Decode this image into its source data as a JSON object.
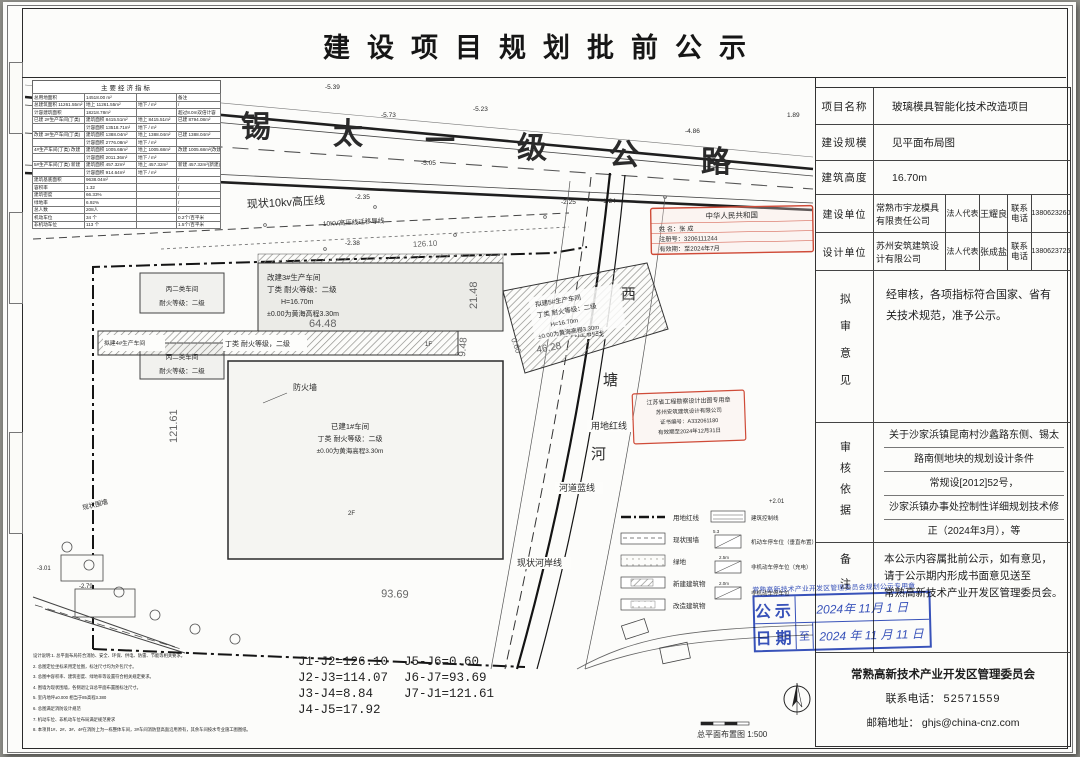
{
  "header": {
    "title": "建设项目规划批前公示"
  },
  "indicators": {
    "title": "主要经济指标",
    "rows": [
      [
        "总用地面积",
        "14518.00 m²",
        "",
        "备注"
      ],
      [
        "总建筑面积 11261.55m²",
        "地上 11261.55m²",
        "地下 / m²",
        "/"
      ],
      [
        "计容建筑面积",
        "18218.78m²",
        "",
        "超过8.0m双倍计容"
      ],
      [
        "已建 2#生产车间(丁类)",
        "建筑面积 8415.51m²",
        "地上 8415.51m²",
        "已建 8794.08m²"
      ],
      [
        "",
        "计容面积 13518.71m²",
        "地下 / m²",
        ""
      ],
      [
        "改建 3#生产车间(丁类)",
        "建筑面积 1388.04m²",
        "地上 1388.04m²",
        "已建 1388.04m²"
      ],
      [
        "",
        "计容面积 2776.08m²",
        "地下 / m²",
        ""
      ],
      [
        "4#生产车间(丁类) 改建",
        "建筑面积 1005.68m²",
        "地上 1005.68m²",
        "改建 1005.68m²(改建)"
      ],
      [
        "",
        "计容面积 2011.36m²",
        "地下 / m²",
        ""
      ],
      [
        "5#生产车间(丁类) 新建",
        "建筑面积 457.32m²",
        "地上 457.32m²",
        "新建 457.32m²(新建)"
      ],
      [
        "",
        "计容面积 914.64m²",
        "地下 / m²",
        ""
      ],
      [
        "建筑基底面积",
        "9638.04m²",
        "",
        "/"
      ],
      [
        "容积率",
        "1.32",
        "",
        "/"
      ],
      [
        "建筑密度",
        "66.33%",
        "",
        "/"
      ],
      [
        "绿地率",
        "6.92%",
        "",
        "/"
      ],
      [
        "总人数",
        "208人",
        "",
        "/"
      ],
      [
        "机动车位",
        "34 个",
        "",
        "0.2个/百平米"
      ],
      [
        "非机动车位",
        "113 个",
        "",
        "1.5个/百平米"
      ]
    ]
  },
  "panel": {
    "project_label": "项目名称",
    "project": "玻璃模具智能化技术改造项目",
    "scale_label": "建设规模",
    "scale": "见平面布局图",
    "height_label": "建筑高度",
    "height": "16.70m",
    "builder_label": "建设单位",
    "builder": "常熟市宇龙模具有限责任公司",
    "legal_label": "法人代表",
    "builder_legal": "王耀良",
    "tel_label": "联系电话",
    "builder_tel": "1380623260",
    "designer_label": "设计单位",
    "designer": "苏州安筑建筑设计有限公司",
    "designer_legal": "张成盐",
    "designer_tel": "1380623726",
    "opinion_label": "拟审意见",
    "opinion": "经审核，各项指标符合国家、省有关技术规范，准予公示。",
    "basis_label": "审核依据",
    "basis_lines": [
      "关于沙家浜镇昆南村沙蠡路东侧、锡太",
      "路南侧地块的规划设计条件",
      "常规设[2012]52号，",
      "沙家浜镇办事处控制性详细规划技术修",
      "正（2024年3月），等"
    ],
    "remark_label": "备注",
    "remark_lines": [
      "本公示内容属批前公示，如有意见，",
      "请于公示期内形成书面意见送至",
      "常熟高新技术产业开发区管理委员会。"
    ],
    "footer_org": "常熟高新技术产业开发区管理委员会",
    "footer_tel_label": "联系电话：",
    "footer_tel": "52571559",
    "footer_email_label": "邮箱地址：",
    "footer_email": "ghjs@china-cnz.com"
  },
  "blue_stamp": {
    "seal_line": "常熟高新技术产业开发区管理委员会规划公示专用章",
    "row1_label": "公示",
    "row2_label": "日期",
    "to": "至",
    "date_from": "2024年 11月 1 日",
    "date_to": "2024 年 11 月 11 日"
  },
  "coords": {
    "col1": [
      "J1-J2=126.10",
      "J2-J3=114.07",
      "J3-J4=8.84",
      "J4-J5=17.92"
    ],
    "col2": [
      "J5-J6=0.60",
      "J6-J7=93.69",
      "J7-J1=121.61"
    ]
  },
  "notes": {
    "lines": [
      "设计说明:1. 总平面布局符合消防、安全、环保、供电、防雷、节能等相关要求。",
      "2. 总图定位坐标采用定位图，标注尺寸均为外包尺寸。",
      "3. 总图中容积率、建筑密度、绿地率等设置符合相关规定要求。",
      "4. 围墙为现状围墙，各侧退让详总平面布置图标注尺寸。",
      "5. 室内地坪±0.000 相当于85高程3.380",
      "6. 总图满足消防设计规范",
      "7. 机动车位、非机动车位布局满足规范要求",
      "8. 本项目1#、2#、3#、4#在消防上为一栋整体车间，3#车间消防登高面沿用原有，其余车间按水专业施工图图纸。"
    ]
  },
  "drawing": {
    "road_chars": [
      "锡",
      "太",
      "一",
      "级",
      "公",
      "路"
    ],
    "power1": "现状10kv高压线",
    "power2": "10KV高压线迁移导线",
    "river": [
      "西",
      "塘",
      "河"
    ],
    "l_ctrl": "建筑控制线",
    "l_red": "用地红线",
    "l_blue": "河道蓝线",
    "l_bank": "现状河岸线",
    "b3": [
      "改建3#生产车间",
      "丁类 耐火等级：二级",
      "H=16.70m",
      "±0.00为黄海高程3.30m"
    ],
    "b4": [
      "拟建4#生产车间",
      "丁类 耐火等级，二级",
      "1F"
    ],
    "b5": [
      "拟建5#生产车间",
      "丁类 耐火等级：二级",
      "H=16.70m",
      "±0.00为黄海高程3.30m"
    ],
    "b1": [
      "已建1#车间",
      "丁类 耐火等级：二级",
      "±0.00为黄海高程3.30m",
      "2F"
    ],
    "bc": [
      "丙二类车间",
      "耐火等级：二级"
    ],
    "firewall": "防火墙",
    "fence": "现状围墙",
    "dims": {
      "d_6448": "64.48",
      "d_2148": "21.48",
      "d_948": "9.48",
      "d_4628": "46.28",
      "d_12161": "121.61",
      "d_9369": "93.69",
      "d_12610": "126.10",
      "d_060": "0.60"
    },
    "elev": {
      "e1": "-5.49",
      "e2": "-5.39",
      "e3": "-5.73",
      "e4": "-5.23",
      "e5": "-5.05",
      "e6": "-4.66",
      "e7": "1.89",
      "e8": "-4.86",
      "e9": "-2.35",
      "e10": "-2.25",
      "e11": "-2.38",
      "e12": "-1.24",
      "e13": "+2.01",
      "e14": "-3.01",
      "e15": "-2.79"
    },
    "legend": {
      "left": [
        "用地红线",
        "现状围墙",
        "绿地",
        "新建建筑物",
        "改造建筑物"
      ],
      "right": [
        "建筑控制线",
        "机动车停车位（垂直布置）",
        "非机动车停车位（充电）",
        "非机动车停车位"
      ],
      "dims": [
        "5.3",
        "2.5m",
        "2.0m"
      ]
    },
    "stamp_arch": [
      "中华人民共和国",
      "姓 名：张 成",
      "注册号：3206111244",
      "有效期：至2024年7月"
    ],
    "stamp_design": [
      "江苏省工程勘察设计出图专用章",
      "苏州安筑建筑设计有限公司",
      "证书编号：A332061180",
      "有效期至2024年12月31日"
    ],
    "caption": "总平面布置图 1:500"
  }
}
